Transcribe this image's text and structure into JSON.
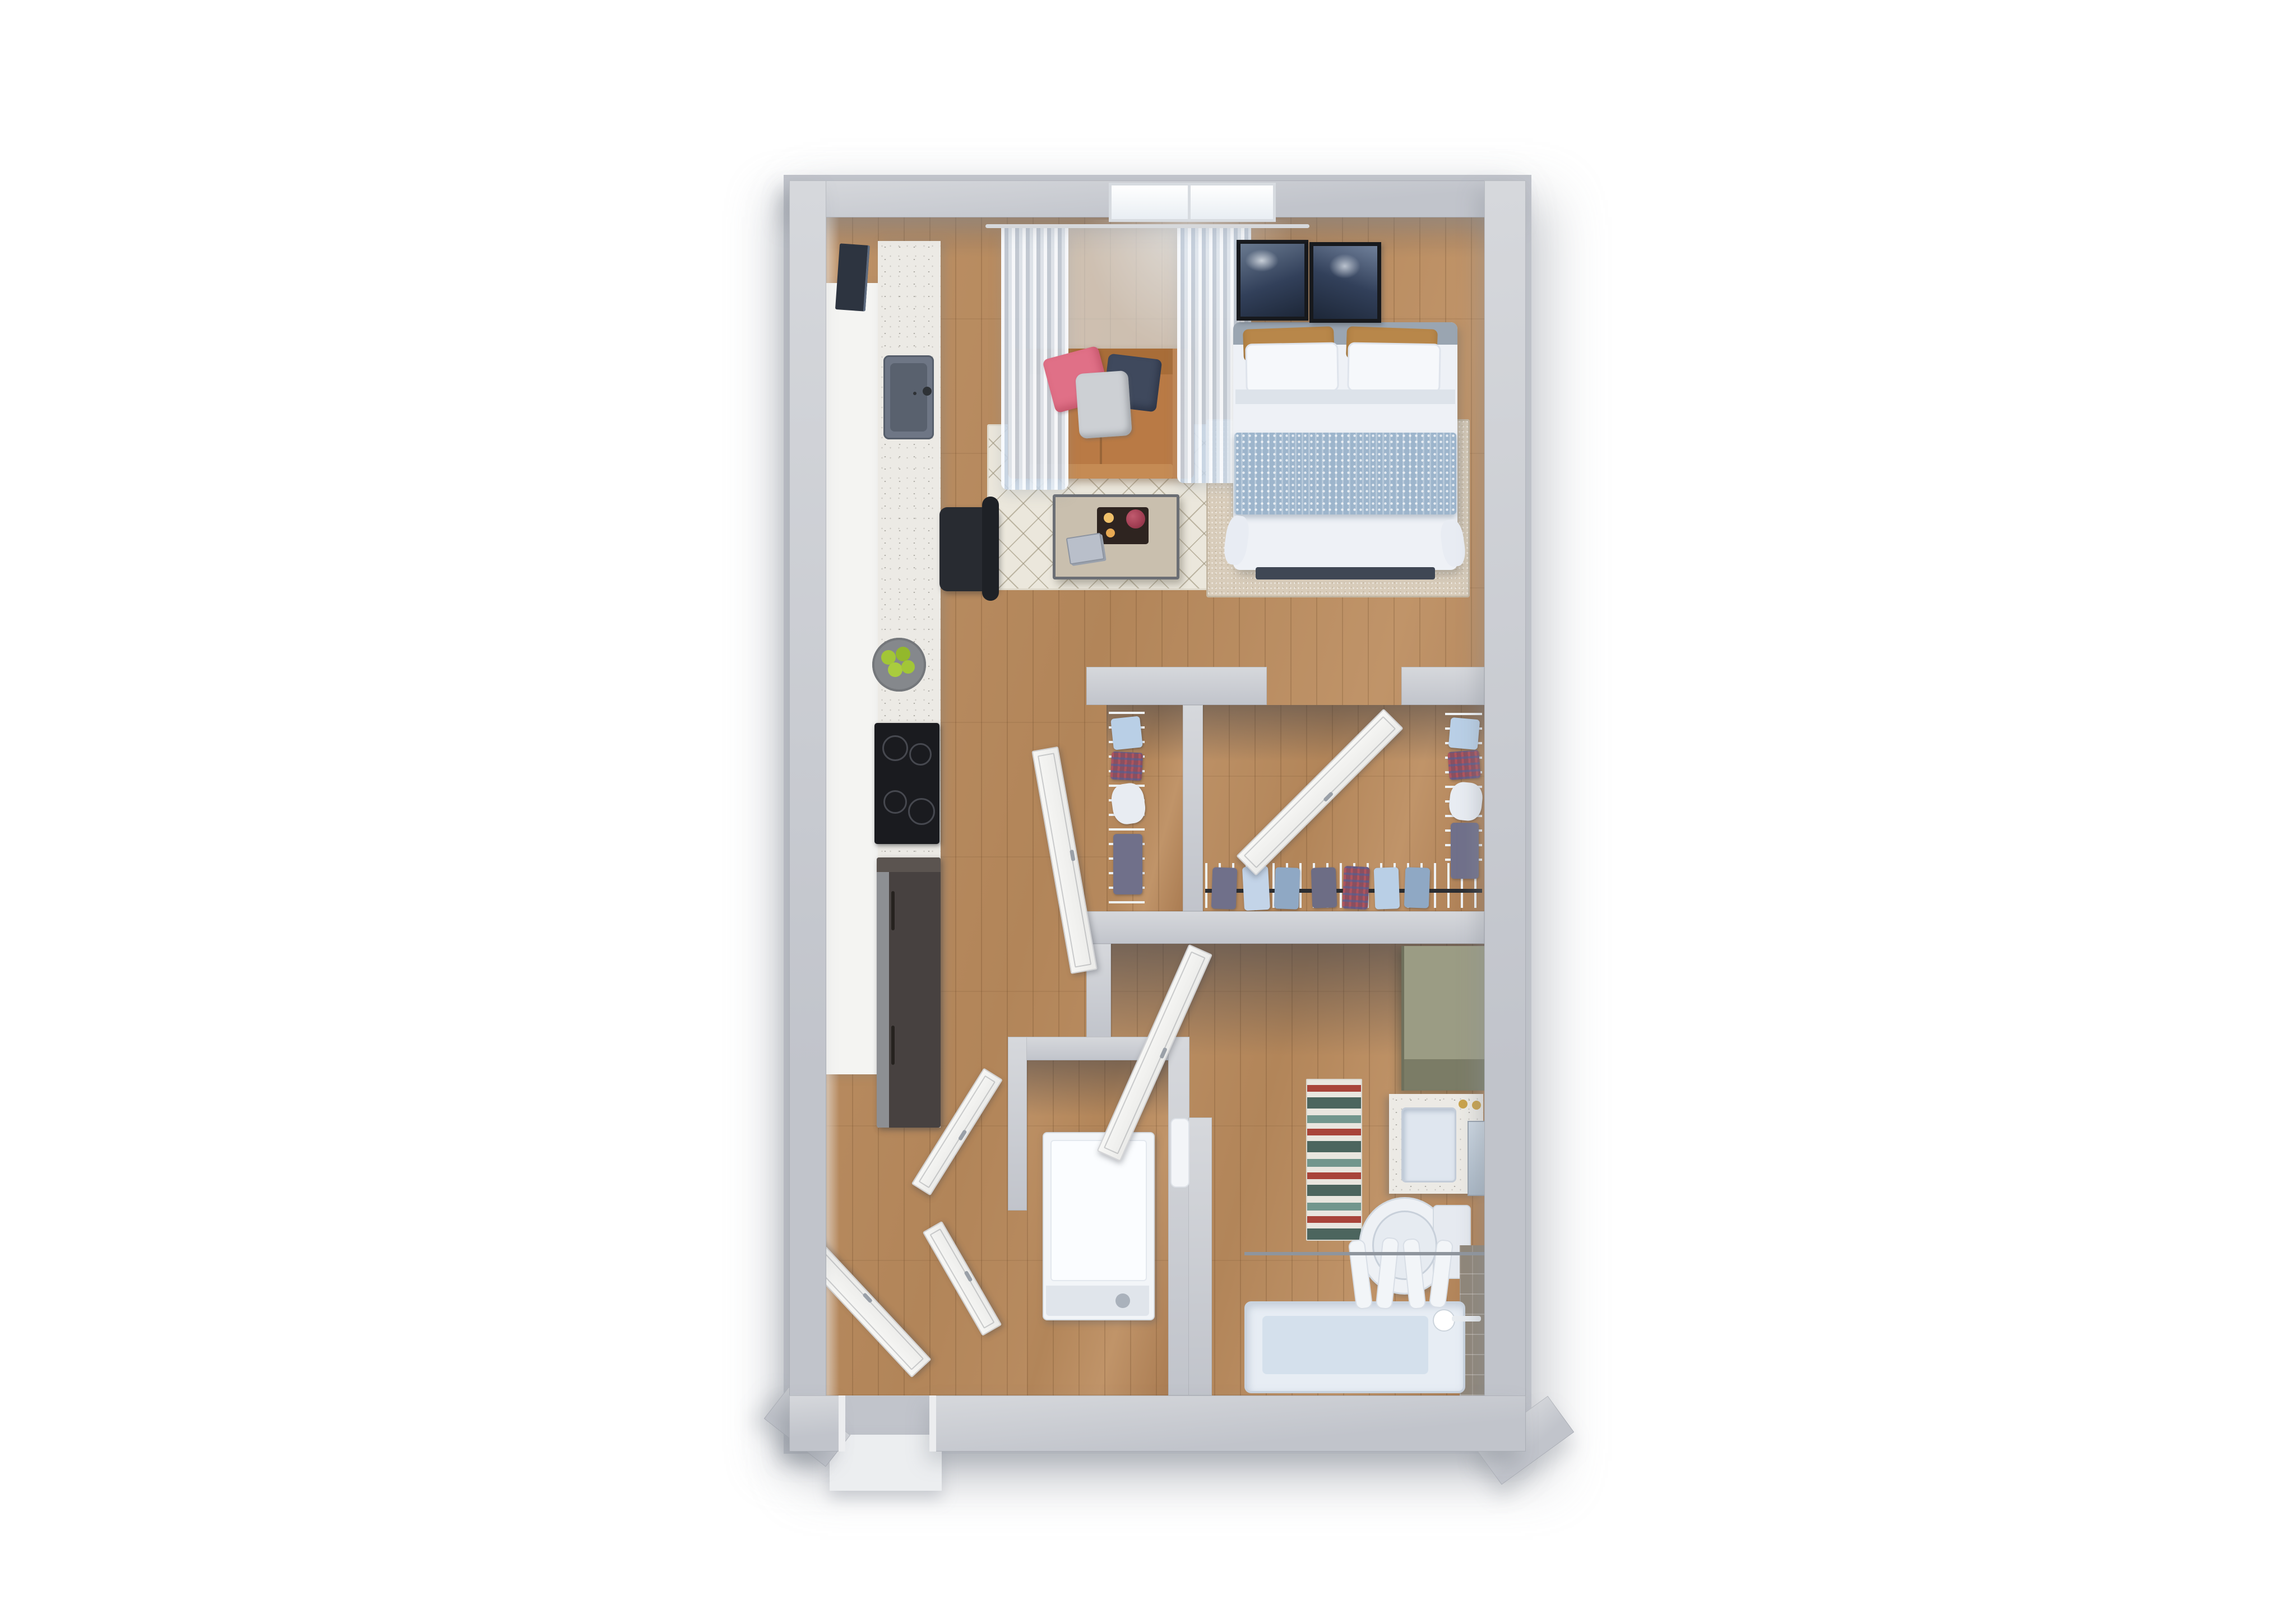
{
  "scene": {
    "title": "Studio apartment 3D floor plan, top-down view",
    "style": "photoreal 3D dollhouse render",
    "background": "#ffffff",
    "text_labels": []
  },
  "palette": {
    "bgWhite": "#ffffff",
    "wall": "#c1c4cb",
    "wallLight": "#d6d8dc",
    "wallDark": "#a9acb3",
    "floorWood": "#b78c60",
    "rugCream": "#ebe7dc",
    "rugBeige": "#d8ccba",
    "sofaTan": "#b97a45",
    "sofaTanDark": "#a86d38",
    "pillowPink": "#e07087",
    "pillowNavy": "#3f495d",
    "throwGray": "#cdd0d4",
    "tableWood": "#c9bfae",
    "metalDark": "#6b6e74",
    "duvetWhite": "#eef1f6",
    "blanketBlue": "#9db5cc",
    "pillowGold": "#b8874a",
    "headboardGray": "#9aa5b1",
    "footboardNavy": "#3f4754",
    "frameBlack": "#17191d",
    "artNavy": "#32405a",
    "curtainBlue": "#cfdcea",
    "windowWhite": "#f7fafc",
    "counterSpeckle": "#eceae5",
    "cabinetWhite": "#f4f4f2",
    "applianceBlack": "#1a1b1f",
    "fridgeBrown": "#474140",
    "sinkSlate": "#6e7685",
    "chairBlack": "#282b31",
    "appleGreen": "#a2c637",
    "wireWhite": "#eef1f4",
    "rodBlack": "#2b2d31",
    "clothesBlue": "#b9cfe6",
    "clothesChambray": "#8fa8c4",
    "clothesPlaid": "#8a4f60",
    "clothesGray": "#70708a",
    "oliveCabinet": "#9b9c84",
    "oliveFront": "#7b7c66",
    "vanityWhite": "#eceef1",
    "sinkBlue": "#dfe6ef",
    "faucetGold": "#c9a24a",
    "rugTeal": "#4c655e",
    "rugRed": "#a8443a",
    "rugIvory": "#e9e6df",
    "porcelain": "#eef1f5",
    "tubBlue": "#d4e0ec",
    "tileTaupe": "#8f8679",
    "washerWhite": "#f2f5f8",
    "doorWhite": "#f7f7f5",
    "handleGray": "#9aa0a8",
    "stoopGray": "#eceef0"
  },
  "rooms": [
    {
      "name": "living-sleeping-area",
      "floor": "wood plank",
      "furniture": [
        "window",
        "sheer-curtains",
        "curtain-rod",
        "wall-art-frame-1",
        "wall-art-frame-2",
        "loveseat",
        "pink-accent-pillow",
        "navy-accent-pillow",
        "gray-throw",
        "cream-diamond-rug",
        "coffee-table",
        "decor-tray",
        "books",
        "counter-chair",
        "queen-bed",
        "gold-pillows",
        "white-pillows",
        "blue-quilt",
        "footboard-bench",
        "beige-bed-rug"
      ]
    },
    {
      "name": "kitchen",
      "floor": "wood plank",
      "furniture": [
        "white-cabinet-run",
        "quartz-counter",
        "tv",
        "kitchen-sink",
        "faucet",
        "fruit-bowl",
        "cooktop",
        "refrigerator"
      ]
    },
    {
      "name": "closet-small",
      "floor": "wood plank",
      "furniture": [
        "wire-shelf-rack",
        "folded-clothes",
        "hanging-clothes",
        "closet-door"
      ]
    },
    {
      "name": "closet-large",
      "floor": "wood plank",
      "furniture": [
        "wire-shelf-rod",
        "hanging-clothes",
        "side-rack",
        "closet-door"
      ]
    },
    {
      "name": "hallway",
      "floor": "wood plank",
      "furniture": [
        "bathroom-door",
        "laundry-bifold-doors",
        "entry-door",
        "hall-towel"
      ]
    },
    {
      "name": "laundry-closet",
      "floor": "wood plank",
      "furniture": [
        "washer-dryer"
      ]
    },
    {
      "name": "bathroom",
      "floor": "wood plank",
      "furniture": [
        "linen-cabinet",
        "vanity",
        "vanity-sink",
        "gold-faucet",
        "mirror",
        "striped-runner-rug",
        "toilet",
        "shower-rod",
        "shower-curtain",
        "bathtub",
        "tub-faucet",
        "tile-surround"
      ]
    }
  ]
}
